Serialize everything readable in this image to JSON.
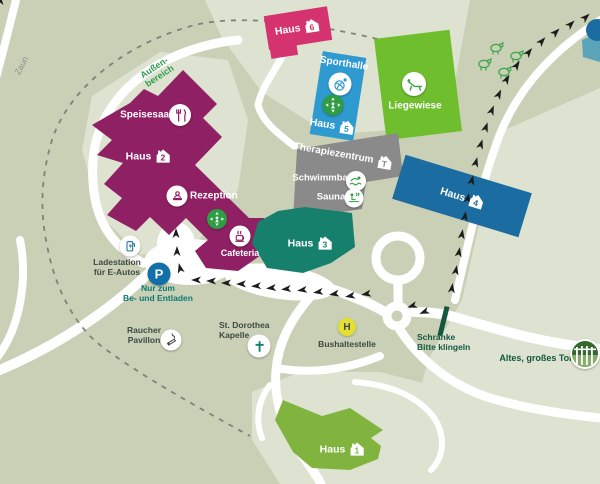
{
  "buildings": {
    "haus1": {
      "label": "Haus",
      "number": "1"
    },
    "haus2": {
      "label": "Haus",
      "number": "2"
    },
    "haus3": {
      "label": "Haus",
      "number": "3"
    },
    "haus4": {
      "label": "Haus",
      "number": "4"
    },
    "haus5": {
      "label": "Haus",
      "number": "5"
    },
    "haus6": {
      "label": "Haus",
      "number": "6"
    },
    "sporthalle": {
      "label": "Sporthalle"
    },
    "therapiezentrum": {
      "label": "Therapiezentrum",
      "icon_letter": "T"
    },
    "liegewiese": {
      "label": "Liegewiese"
    }
  },
  "facilities": {
    "speisesaal": {
      "label": "Speisesaal"
    },
    "rezeption": {
      "label": "Rezeption"
    },
    "cafeteria": {
      "label": "Cafeteria"
    },
    "schwimmbad": {
      "label": "Schwimmbad"
    },
    "sauna": {
      "label": "Sauna"
    }
  },
  "points": {
    "ladestation": {
      "line1": "Ladestation",
      "line2": "für E-Autos"
    },
    "parking": {
      "badge": "P",
      "note1": "Nur zum",
      "note2": "Be- und Entladen"
    },
    "raucher": {
      "line1": "Raucher",
      "line2": "Pavillon"
    },
    "kapelle": {
      "line1": "St. Dorothea",
      "line2": "Kapelle"
    },
    "bus": {
      "badge": "H",
      "label": "Bushaltestelle"
    },
    "schranke": {
      "line1": "Schranke",
      "line2": "Bitte klingeln"
    },
    "tor": {
      "label": "Altes, großes Tor"
    }
  },
  "areas": {
    "zaun": "Zaun",
    "aussen1": "Außen-",
    "aussen2": "bereich"
  },
  "colors": {
    "background": "#c9d0b6",
    "background_light": "#dde3d0",
    "road": "#ffffff",
    "haus1": "#80b43f",
    "haus2": "#8f2063",
    "haus3": "#17806d",
    "haus4": "#1b6da1",
    "haus5_sporthalle": "#2f9ad0",
    "haus6": "#d4336f",
    "liegewiese": "#6fbe2d",
    "therapiezentrum": "#8a8a8a",
    "assembly_point": "#2f9e42",
    "parking_badge": "#1170a8",
    "bus_badge": "#e3df33",
    "barrier": "#14573f",
    "fence": "#7d837b"
  }
}
